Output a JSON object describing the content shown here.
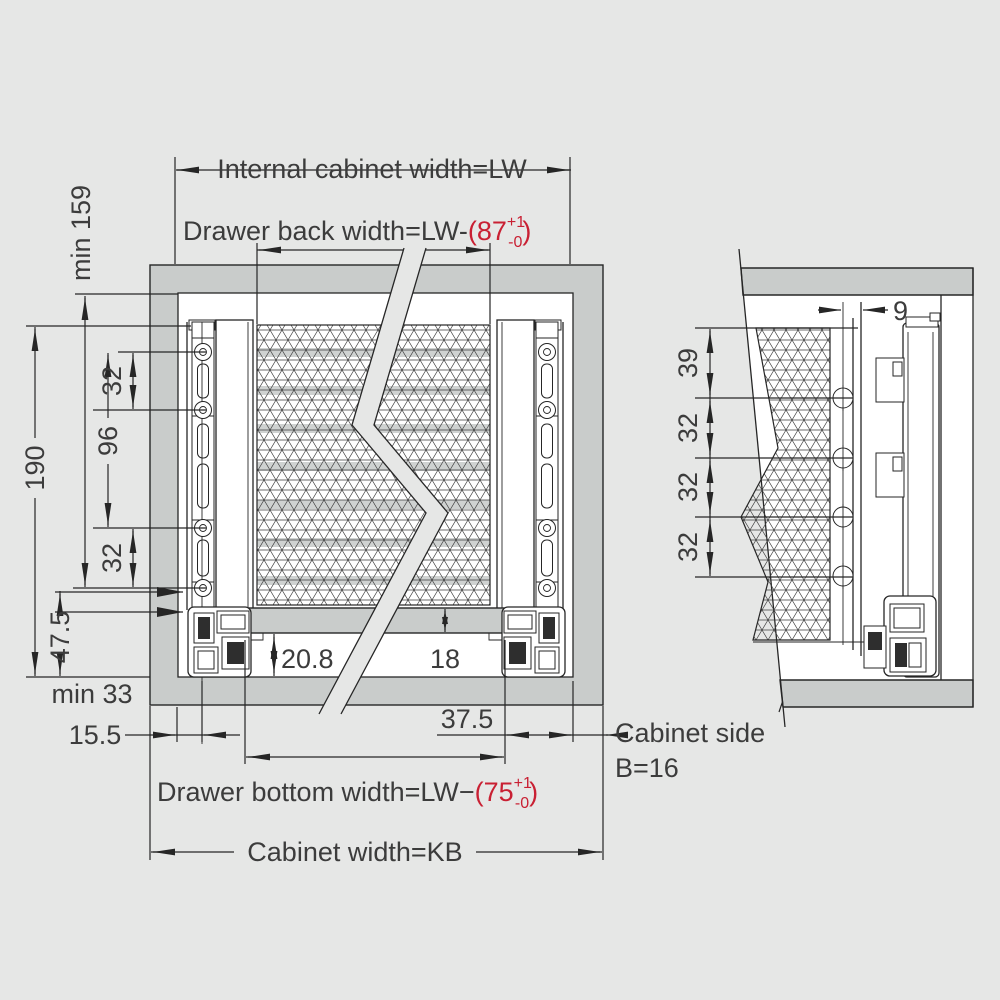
{
  "colors": {
    "page_bg": "#e6e7e6",
    "panel_gray": "#c9cccb",
    "stripe_gray": "#cfd2d1",
    "line": "#262626",
    "text": "#3c3c3c",
    "accent_red": "#c92033"
  },
  "front_view": {
    "top": {
      "internal_width": "Internal cabinet width=LW",
      "back_width_prefix": "Drawer back width=LW-",
      "back_width_value": "(87",
      "back_tol_plus": "+1",
      "back_tol_minus": "-0",
      "back_close": ")"
    },
    "left": {
      "min_height": "min 159",
      "overall": "190",
      "pitch_top": "32",
      "pitch_mid": "96",
      "pitch_bottom": "32",
      "bottom_offset": "47.5",
      "min_clearance": "min 33",
      "front_inset": "15.5"
    },
    "bottom": {
      "recess_depth": "20.8",
      "panel_gap": "18",
      "side_gap": "37.5",
      "bottom_width_prefix": "Drawer bottom width=LW−",
      "bottom_width_value": "(75",
      "bottom_tol_plus": "+1",
      "bottom_tol_minus": "-0",
      "bottom_close": ")",
      "cabinet_width": "Cabinet width=KB"
    }
  },
  "side_view": {
    "dims": {
      "front_offset": "9",
      "top_pitch": "39",
      "pitch1": "32",
      "pitch2": "32",
      "pitch3": "32"
    },
    "labels": {
      "cabinet_side": "Cabinet side",
      "side_thickness": "B=16"
    }
  }
}
